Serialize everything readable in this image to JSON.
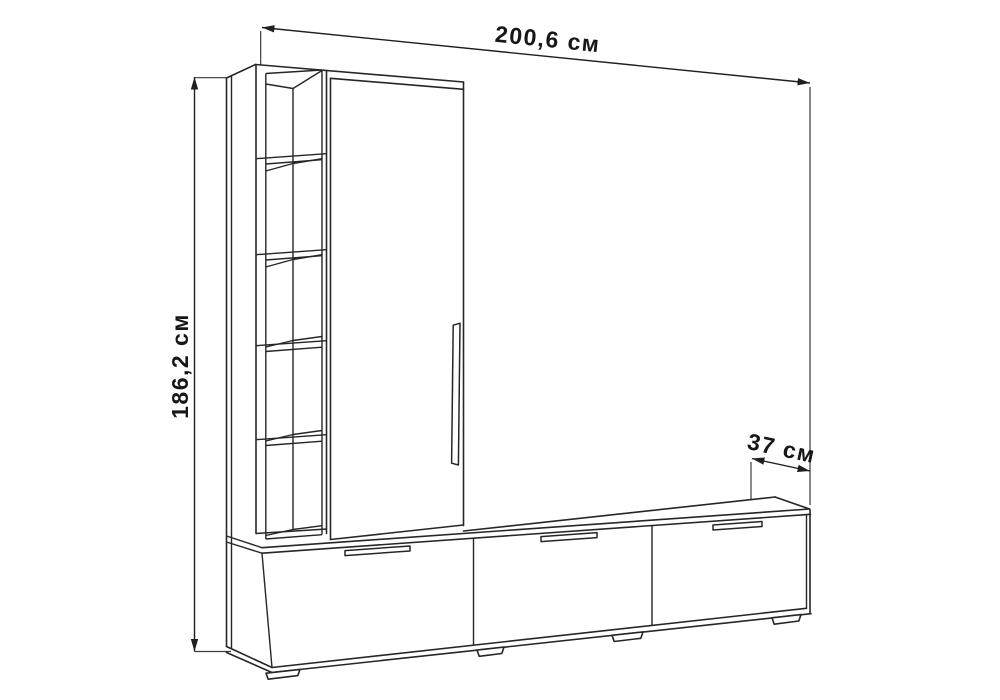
{
  "diagram": {
    "type": "furniture-dimension-drawing",
    "item": "wall-unit with wardrobe, open shelf tower and TV stand",
    "dimensions": {
      "width": {
        "label": "200,6 см",
        "value_cm": 200.6,
        "position": "top"
      },
      "height": {
        "label": "186,2 см",
        "value_cm": 186.2,
        "position": "left"
      },
      "depth": {
        "label": "37 см",
        "value_cm": 37,
        "position": "right"
      }
    },
    "features": {
      "open_shelf_compartments": 5,
      "wardrobe_doors": 1,
      "tv_stand_drawers": 3,
      "feet": 4
    },
    "colors": {
      "background": "#ffffff",
      "line": "#262626",
      "text": "#171717"
    }
  }
}
